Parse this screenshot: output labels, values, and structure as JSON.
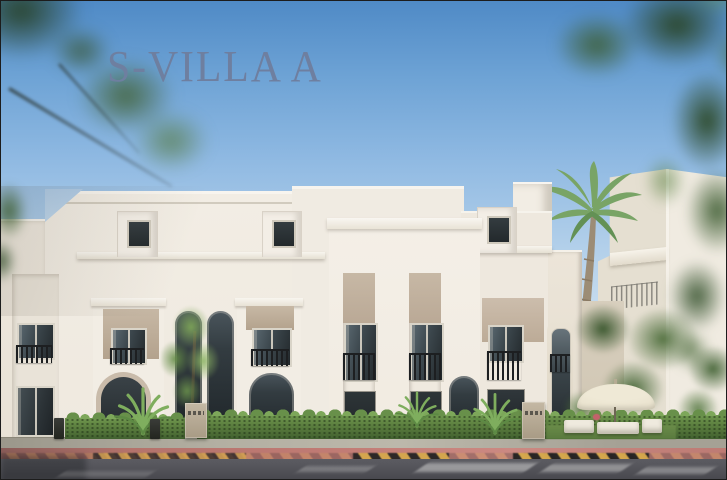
{
  "title": {
    "text": "S-VILLA A"
  },
  "colors": {
    "skyTop": "#4f8ac6",
    "skyMid": "#8fb9e2",
    "skyHorizon": "#d9e8f4",
    "titleText": "#6e7fa0",
    "wallLight": "#f3eee5",
    "wallMid": "#eae4d9",
    "wallShade": "#ddd5c7",
    "tanPanel": "#c7b8a5",
    "tanDark": "#b3a28d",
    "frameTrim": "#d9d4c8",
    "glassDark": "#23292c",
    "glassLight": "#5a6870",
    "railing": "#1d1f21",
    "hedgeDark": "#41602f",
    "hedgeMid": "#5d8040",
    "hedgeLight": "#7da75a",
    "treeBright": "#8cb467",
    "foliageDark": "#2f5129",
    "foliageMid": "#4f7a3c",
    "palmFrond": "#79a466",
    "palmTrunk": "#9c8c75",
    "lawn": "#6a8c49",
    "pavement": "#b3afa2",
    "redLane": "#c07b74",
    "curbYellow": "#d6a94b",
    "curbBlack": "#212121",
    "asphalt": "#55555b",
    "asphaltDark": "#47474d",
    "roadMark": "#e8e8e6",
    "umbrella": "#e7e0cb",
    "furniture": "#efeade",
    "pillarStone": "#b9ac97",
    "bgBuilding": "#f0ebe1"
  }
}
